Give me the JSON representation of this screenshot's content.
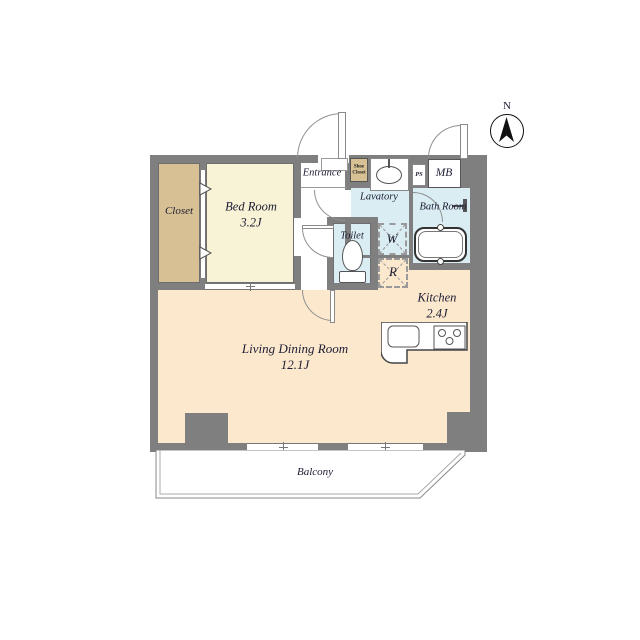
{
  "plan": {
    "compass_label": "N",
    "rooms": {
      "closet": {
        "label": "Closet"
      },
      "bedroom": {
        "label": "Bed Room",
        "size": "3.2J"
      },
      "entrance": {
        "label": "Entrance"
      },
      "shoe_closet": {
        "label": "Shoe Closet"
      },
      "lavatory": {
        "label": "Lavatory"
      },
      "bathroom": {
        "label": "Bath Room"
      },
      "toilet": {
        "label": "Toilet"
      },
      "kitchen": {
        "label": "Kitchen",
        "size": "2.4J"
      },
      "living_dining": {
        "label": "Living Dining Room",
        "size": "12.1J"
      },
      "balcony": {
        "label": "Balcony"
      }
    },
    "annotations": {
      "meter_box": "MB",
      "pipe_space": "PS",
      "washer": "W",
      "refrigerator": "R"
    },
    "colors": {
      "wall": "#7f7f7f",
      "bedroom_fill": "#f8f3d6",
      "closet_fill": "#d7c093",
      "wet_area_fill": "#d9edf2",
      "living_fill": "#fce8cd",
      "text": "#1c1c33"
    }
  }
}
